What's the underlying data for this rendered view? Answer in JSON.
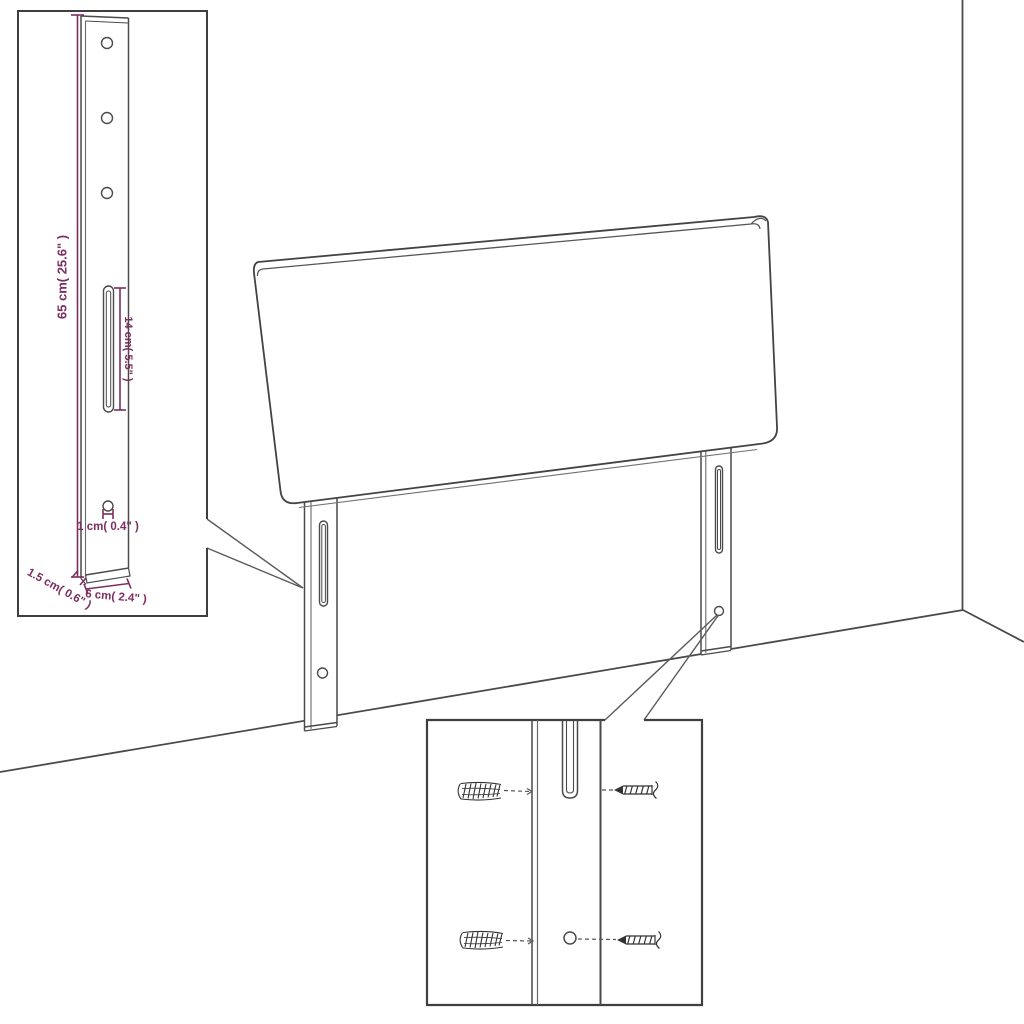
{
  "diagram": {
    "title": "headboard-with-mounting-legs-dimension-diagram",
    "colors": {
      "outline": "#434343",
      "dimension": "#7b2e61",
      "leader": "#5a5a5a",
      "background": "#ffffff"
    },
    "dimension_labels": {
      "leg_height": "65 cm( 25.6\" )",
      "slot_length": "14 cm( 5.5\" )",
      "hole_diameter": "1 cm( 0.4\" )",
      "leg_thickness": "1.5 cm( 0.6\" )",
      "leg_width": "6 cm( 2.4\" )"
    }
  }
}
